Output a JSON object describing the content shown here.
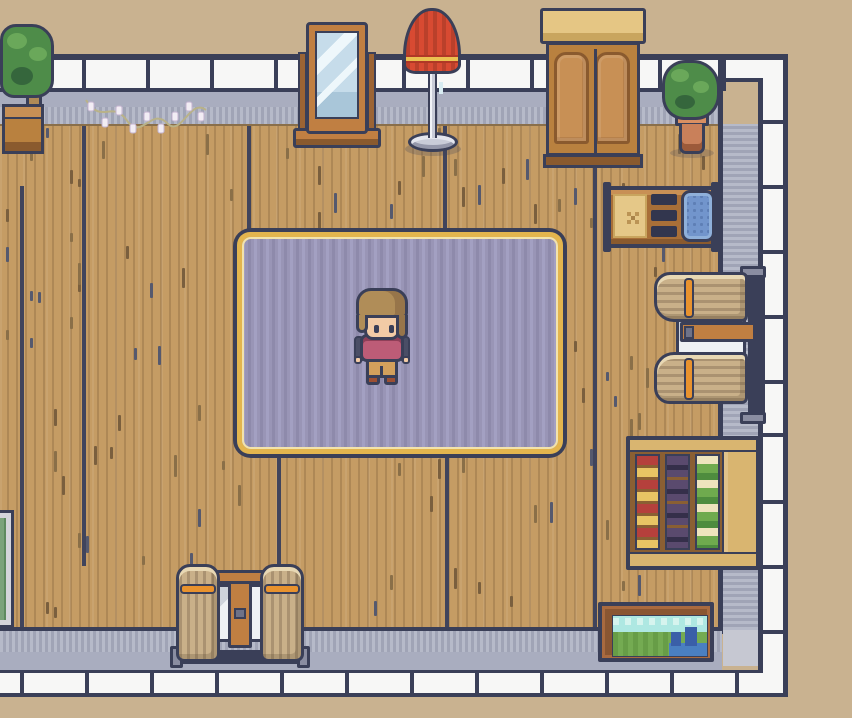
{
  "meta": {
    "title": "Top-down pixel-art room scene",
    "canvas": {
      "w": 852,
      "h": 718
    }
  },
  "palette": {
    "outside": "#c9b290",
    "outline": "#3a3f58",
    "wallwhite": "#f7f7f6",
    "grayflat": "#a9adbf",
    "gstripe-a": "#b6bac9",
    "gstripe-b": "#a0a4b6",
    "graycap": "#c6c8d2",
    "floor": "#c59c64",
    "floorline": "#40445c",
    "wood-mid": "#b9813f",
    "wood-dark": "#8a5a2e",
    "wood-light": "#c89055",
    "wood-pale": "#e5c684",
    "rug": "#9995b6",
    "rug-a": "#a3a0c2",
    "rug-b": "#8e8aab",
    "gold": "#e3b54e",
    "gold-pale": "#f2e3ac",
    "green-main": "#4e8c49",
    "green-light": "#6aa85a",
    "green-dark": "#35663c",
    "terracotta": "#c9805a",
    "terracotta-rim": "#d98f62",
    "red": "#d84a32",
    "red-dark": "#b03826",
    "gold-band": "#ebc050",
    "metal": "#c9ccd8",
    "metal-dark": "#8a8da1",
    "curtain": "#c9b089",
    "curtain-fold": "rgba(90,70,50,.28)",
    "curtain-hi": "#e8d8b4",
    "tie": "#e8922e",
    "white-pane": "#eef1f4",
    "book-red": "#b5403c",
    "book-yellow": "#e8c464",
    "book-purple": "#5a4a6e",
    "book-dark": "#352f4a",
    "book-green": "#6faa4e",
    "book-green2": "#4e8c3e",
    "book-cream": "#eee4bd",
    "shelf-bg": "#8a5f33",
    "shelf-tan": "#d9b570",
    "paint-sky": "#aee8e2",
    "paint-sky2": "#d6f4ee",
    "paint-green": "#74ab52",
    "paint-green2": "#5e9440",
    "paint-blue": "#4a7fc1",
    "paint-blue2": "#3a5fa8",
    "frame-brown": "#8a5632",
    "skin": "#f2cba6",
    "hair": "#b08d58",
    "hair-dark": "#97754a",
    "top-pink": "#bd5c77",
    "pants": "#d3a05c",
    "shoes": "#9c4f33",
    "arm": "#4a4e66",
    "blue-pad": "#7295cc",
    "mat": "#e5c888"
  },
  "room": {
    "wall_ticks_top": [
      82,
      146,
      210,
      274,
      338,
      402,
      466,
      530,
      594,
      658,
      722
    ],
    "wall_ticks_bottom": [
      20,
      85,
      150,
      215,
      280,
      345,
      410,
      475,
      540,
      605,
      670,
      735
    ],
    "wall_ticks_right": [
      120,
      185,
      250,
      315,
      380,
      433,
      500,
      565,
      630
    ],
    "floor_lines": [
      {
        "x": 20,
        "y1": 186,
        "y2": 631
      },
      {
        "x": 82,
        "y1": 126,
        "y2": 566
      },
      {
        "x": 247,
        "y1": 126,
        "y2": 233
      },
      {
        "x": 277,
        "y1": 456,
        "y2": 631
      },
      {
        "x": 443,
        "y1": 126,
        "y2": 236
      },
      {
        "x": 445,
        "y1": 456,
        "y2": 631
      },
      {
        "x": 593,
        "y1": 126,
        "y2": 631
      }
    ]
  },
  "objects": [
    {
      "id": "potted-tree",
      "label": "Potted tree",
      "x": 0,
      "y": 24,
      "w": 62,
      "h": 130
    },
    {
      "id": "string-lights",
      "label": "String lights garland",
      "x": 84,
      "y": 92,
      "w": 124,
      "h": 52
    },
    {
      "id": "standing-mirror",
      "label": "Standing mirror",
      "x": 293,
      "y": 22,
      "w": 88,
      "h": 132
    },
    {
      "id": "floor-lamp",
      "label": "Red floor lamp",
      "x": 403,
      "y": 8,
      "w": 60,
      "h": 148
    },
    {
      "id": "wardrobe",
      "label": "Wooden wardrobe",
      "x": 538,
      "y": 8,
      "w": 110,
      "h": 160
    },
    {
      "id": "potted-plant",
      "label": "Potted plant",
      "x": 662,
      "y": 60,
      "w": 58,
      "h": 98
    },
    {
      "id": "work-table",
      "label": "Work table with blue cushion",
      "x": 601,
      "y": 184,
      "w": 120,
      "h": 66
    },
    {
      "id": "window-right",
      "label": "Curtained window on right wall",
      "x": 652,
      "y": 266,
      "w": 116,
      "h": 160
    },
    {
      "id": "bookshelf",
      "label": "Bookshelf with books",
      "x": 626,
      "y": 436,
      "w": 134,
      "h": 134
    },
    {
      "id": "painting",
      "label": "Landscape painting",
      "x": 598,
      "y": 602,
      "w": 116,
      "h": 60
    },
    {
      "id": "window-bottom",
      "label": "Curtained window on bottom wall",
      "x": 170,
      "y": 556,
      "w": 140,
      "h": 120
    },
    {
      "id": "green-partial",
      "label": "Green-topped furniture (cut off)",
      "x": 0,
      "y": 510,
      "w": 14,
      "h": 118
    },
    {
      "id": "rug",
      "label": "Lavender rug with gold trim",
      "x": 233,
      "y": 228,
      "w": 334,
      "h": 230
    },
    {
      "id": "character",
      "label": "Player character",
      "x": 354,
      "y": 288,
      "w": 56,
      "h": 100
    }
  ]
}
